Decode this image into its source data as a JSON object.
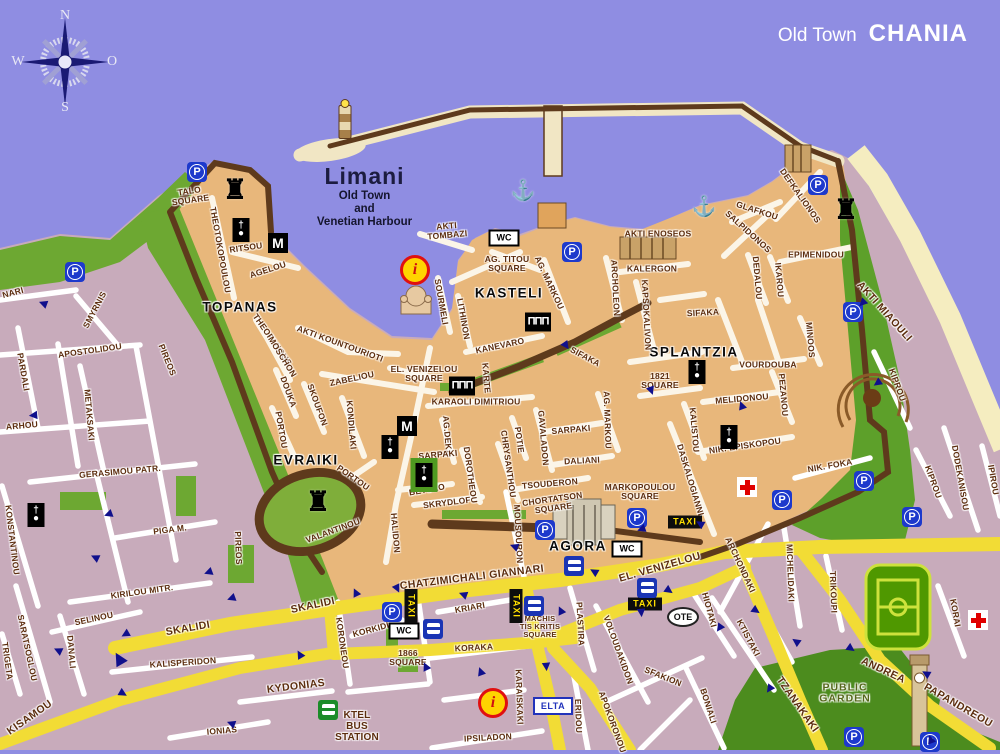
{
  "title": {
    "prefix": "Old Town",
    "name": "CHANIA"
  },
  "compass": {
    "n": "N",
    "e": "O",
    "s": "S",
    "w": "W"
  },
  "harbor": {
    "name": "Limani",
    "line1": "Old Town",
    "line2": "and",
    "line3": "Venetian Harbour"
  },
  "colors": {
    "sea": "#8f8de2",
    "old_town": "#e8b77b",
    "new_town": "#c8abbb",
    "park_green": "#6da832",
    "dark_green": "#4c8c1e",
    "road_yellow": "#f2dc35",
    "wall_brown": "#5e3a1c",
    "sand": "#f5edc0",
    "label_brown": "#5c2d0e",
    "sign_blue": "#1d39cc",
    "arrow_navy": "#10108c",
    "taxi_yellow": "#ffe000"
  },
  "arrow_glyph": "▶",
  "map": {
    "labels": [
      {
        "t": "TALO\nSQUARE",
        "x": 190,
        "y": 196,
        "r": -8,
        "c": "sq"
      },
      {
        "t": "THEOTOKOPOULOU",
        "x": 220,
        "y": 250,
        "r": 80
      },
      {
        "t": "RITSOU",
        "x": 246,
        "y": 248,
        "r": -8
      },
      {
        "t": "AGELOU",
        "x": 268,
        "y": 270,
        "r": -18
      },
      {
        "t": "TOPANAS",
        "x": 240,
        "y": 308,
        "c": "district"
      },
      {
        "t": "KASTELI",
        "x": 509,
        "y": 294,
        "c": "district"
      },
      {
        "t": "EVRAIKI",
        "x": 306,
        "y": 461,
        "c": "district"
      },
      {
        "t": "SPLANTZIA",
        "x": 694,
        "y": 353,
        "c": "district"
      },
      {
        "t": "AGORA",
        "x": 578,
        "y": 547,
        "c": "district"
      },
      {
        "t": "AKTI\nTOMBAZI",
        "x": 447,
        "y": 231,
        "r": -5,
        "c": "sq"
      },
      {
        "t": "AG. TITOU\nSQUARE",
        "x": 507,
        "y": 264,
        "c": "sq"
      },
      {
        "t": "AKTI ENOSEOS",
        "x": 658,
        "y": 234
      },
      {
        "t": "KALERGON",
        "x": 652,
        "y": 269
      },
      {
        "t": "EPIMENIDOU",
        "x": 816,
        "y": 255
      },
      {
        "t": "GLAFKOU",
        "x": 757,
        "y": 211,
        "r": 18
      },
      {
        "t": "SALPIDONOS",
        "x": 748,
        "y": 232,
        "r": 42
      },
      {
        "t": "DEFKALIONOS",
        "x": 800,
        "y": 196,
        "r": 55
      },
      {
        "t": "DEDALOU",
        "x": 757,
        "y": 278,
        "r": 85
      },
      {
        "t": "IKAROU",
        "x": 779,
        "y": 280,
        "r": 85
      },
      {
        "t": "ARCHOLEON",
        "x": 615,
        "y": 288,
        "r": 87
      },
      {
        "t": "KAPSOKALIVON",
        "x": 646,
        "y": 315,
        "r": 87
      },
      {
        "t": "SIFAKA",
        "x": 703,
        "y": 313,
        "r": -3
      },
      {
        "t": "SIFAKA",
        "x": 585,
        "y": 357,
        "r": 28
      },
      {
        "t": "AG. MARKOU",
        "x": 549,
        "y": 283,
        "r": 65
      },
      {
        "t": "AG. MARKOU",
        "x": 607,
        "y": 420,
        "r": 88
      },
      {
        "t": "SOURMELI",
        "x": 441,
        "y": 302,
        "r": 80
      },
      {
        "t": "LITHINON",
        "x": 463,
        "y": 319,
        "r": 80
      },
      {
        "t": "KANEVARO",
        "x": 500,
        "y": 346,
        "r": -12
      },
      {
        "t": "KARTE",
        "x": 486,
        "y": 378,
        "r": 85
      },
      {
        "t": "KARAOLI DIMITRIOU",
        "x": 476,
        "y": 402
      },
      {
        "t": "EL. VENIZELOU\nSQUARE",
        "x": 424,
        "y": 374,
        "c": "sq"
      },
      {
        "t": "AKTI KOUNTOURIOTI",
        "x": 340,
        "y": 344,
        "r": 20
      },
      {
        "t": "THEOFANOUS",
        "x": 272,
        "y": 340,
        "r": 55
      },
      {
        "t": "MOSCHON",
        "x": 282,
        "y": 357,
        "r": 58
      },
      {
        "t": "DOUKA",
        "x": 288,
        "y": 392,
        "r": 70
      },
      {
        "t": "ZABELIOU",
        "x": 352,
        "y": 379,
        "r": -12
      },
      {
        "t": "SKOUFON",
        "x": 317,
        "y": 405,
        "r": 70
      },
      {
        "t": "KONDILAKI",
        "x": 351,
        "y": 425,
        "r": 85
      },
      {
        "t": "PORTOU",
        "x": 281,
        "y": 430,
        "r": 80
      },
      {
        "t": "PORTOU",
        "x": 353,
        "y": 478,
        "r": 35
      },
      {
        "t": "VALANTINOU",
        "x": 333,
        "y": 531,
        "r": -20
      },
      {
        "t": "HALIDON",
        "x": 395,
        "y": 533,
        "r": 85
      },
      {
        "t": "BETOLO",
        "x": 427,
        "y": 490,
        "r": -10
      },
      {
        "t": "SKRYDLOF",
        "x": 447,
        "y": 503,
        "r": -7
      },
      {
        "t": "AG.DEKA",
        "x": 447,
        "y": 436,
        "r": 85
      },
      {
        "t": "SARPAKI",
        "x": 438,
        "y": 455,
        "r": -5
      },
      {
        "t": "DOROTHEOU",
        "x": 470,
        "y": 475,
        "r": 82
      },
      {
        "t": "CHRYSANTHOU",
        "x": 508,
        "y": 464,
        "r": 82
      },
      {
        "t": "POTIE",
        "x": 519,
        "y": 440,
        "r": 82
      },
      {
        "t": "GAVALADON",
        "x": 543,
        "y": 438,
        "r": 85
      },
      {
        "t": "SARPAKI",
        "x": 571,
        "y": 430,
        "r": -5
      },
      {
        "t": "DALIANI",
        "x": 582,
        "y": 461,
        "r": -3
      },
      {
        "t": "TSOUDERON",
        "x": 550,
        "y": 484,
        "r": -5
      },
      {
        "t": "CHORTATSON\nSQUARE",
        "x": 553,
        "y": 504,
        "r": -8,
        "c": "sq"
      },
      {
        "t": "MARKOPOULOU\nSQUARE",
        "x": 640,
        "y": 492,
        "c": "sq"
      },
      {
        "t": "MOUSOURON",
        "x": 518,
        "y": 534,
        "r": 87
      },
      {
        "t": "DASKALOGIANNI",
        "x": 690,
        "y": 480,
        "r": 73
      },
      {
        "t": "KALISTOU",
        "x": 694,
        "y": 430,
        "r": 85
      },
      {
        "t": "NIK. EPISKOPOU",
        "x": 745,
        "y": 446,
        "r": -8
      },
      {
        "t": "MELIDONOU",
        "x": 742,
        "y": 399,
        "r": -5
      },
      {
        "t": "VOURDOUBA",
        "x": 768,
        "y": 365
      },
      {
        "t": "MINOOS",
        "x": 810,
        "y": 340,
        "r": 85
      },
      {
        "t": "PEZANOU",
        "x": 783,
        "y": 395,
        "r": 85
      },
      {
        "t": "1821\nSQUARE",
        "x": 660,
        "y": 381,
        "c": "sq"
      },
      {
        "t": "AKTI MIAOULI",
        "x": 884,
        "y": 312,
        "r": 48,
        "c": "road"
      },
      {
        "t": "KIPROU",
        "x": 897,
        "y": 385,
        "r": 70
      },
      {
        "t": "KIPROU",
        "x": 933,
        "y": 482,
        "r": 70
      },
      {
        "t": "DODEKANISOU",
        "x": 960,
        "y": 478,
        "r": 80
      },
      {
        "t": "IPIROU",
        "x": 993,
        "y": 480,
        "r": 80
      },
      {
        "t": "NIK. FOKA",
        "x": 830,
        "y": 466,
        "r": -10
      },
      {
        "t": "MACHIS\nTIS KRITIS\nSQUARE",
        "x": 540,
        "y": 627,
        "c": "sq",
        "fs": 7.5
      },
      {
        "t": "CHATZIMICHALI GIANNARI",
        "x": 472,
        "y": 578,
        "r": -7,
        "c": "road"
      },
      {
        "t": "EL. VENIZELOU",
        "x": 660,
        "y": 568,
        "r": -16,
        "c": "road"
      },
      {
        "t": "KRIARI",
        "x": 470,
        "y": 608,
        "r": -10
      },
      {
        "t": "KORAKA",
        "x": 474,
        "y": 648,
        "r": -3
      },
      {
        "t": "KORKIDI",
        "x": 371,
        "y": 630,
        "r": -15
      },
      {
        "t": "1866\nSQUARE",
        "x": 408,
        "y": 658,
        "c": "sq"
      },
      {
        "t": "KORONEOU",
        "x": 342,
        "y": 643,
        "r": 82
      },
      {
        "t": "SKALIDI",
        "x": 188,
        "y": 629,
        "r": -10,
        "c": "road"
      },
      {
        "t": "SKALIDI",
        "x": 313,
        "y": 606,
        "r": -12,
        "c": "road"
      },
      {
        "t": "KALISPERIDON",
        "x": 183,
        "y": 663,
        "r": -4
      },
      {
        "t": "KYDONIAS",
        "x": 296,
        "y": 687,
        "r": -7,
        "c": "road"
      },
      {
        "t": "IONIAS",
        "x": 222,
        "y": 731,
        "r": -5
      },
      {
        "t": "KISAMOU",
        "x": 30,
        "y": 718,
        "r": -35,
        "c": "road"
      },
      {
        "t": "SELINOU",
        "x": 94,
        "y": 619,
        "r": -12
      },
      {
        "t": "DANALI",
        "x": 71,
        "y": 652,
        "r": 85
      },
      {
        "t": "SARATSOGLOU",
        "x": 27,
        "y": 648,
        "r": 78
      },
      {
        "t": "TRIGETA",
        "x": 7,
        "y": 661,
        "r": 82
      },
      {
        "t": "KIRILOU MITR.",
        "x": 142,
        "y": 592,
        "r": -8
      },
      {
        "t": "PIGA M.",
        "x": 170,
        "y": 530,
        "r": -7
      },
      {
        "t": "GERASIMOU PATR.",
        "x": 120,
        "y": 472,
        "r": -5
      },
      {
        "t": "KONSTANTINOU",
        "x": 12,
        "y": 540,
        "r": 83
      },
      {
        "t": "METAKSAKI",
        "x": 89,
        "y": 415,
        "r": 85
      },
      {
        "t": "PARDALI",
        "x": 23,
        "y": 372,
        "r": 80
      },
      {
        "t": "APOSTOLIDOU",
        "x": 90,
        "y": 351,
        "r": -8
      },
      {
        "t": "SMYRNIS",
        "x": 95,
        "y": 310,
        "r": -62
      },
      {
        "t": "NARI",
        "x": 13,
        "y": 293,
        "r": -15
      },
      {
        "t": "ARHOU",
        "x": 22,
        "y": 426,
        "r": -5
      },
      {
        "t": "PIREOS",
        "x": 167,
        "y": 360,
        "r": 68
      },
      {
        "t": "PIREOS",
        "x": 238,
        "y": 548,
        "r": 88
      },
      {
        "t": "KTEL\nBUS\nSTATION",
        "x": 357,
        "y": 727,
        "c": "sq",
        "fs": 10
      },
      {
        "t": "IPSILADON",
        "x": 488,
        "y": 738,
        "r": -3
      },
      {
        "t": "KARAISKAKI",
        "x": 519,
        "y": 697,
        "r": 88
      },
      {
        "t": "PLASTIRA",
        "x": 580,
        "y": 624,
        "r": 87
      },
      {
        "t": "VOLOUDAKIDON",
        "x": 618,
        "y": 650,
        "r": 70
      },
      {
        "t": "SFAKION",
        "x": 663,
        "y": 677,
        "r": 22
      },
      {
        "t": "APOKORONOU",
        "x": 612,
        "y": 722,
        "r": 70
      },
      {
        "t": "ERIDOU",
        "x": 578,
        "y": 716,
        "r": 88
      },
      {
        "t": "BONIALI",
        "x": 708,
        "y": 706,
        "r": 72
      },
      {
        "t": "KTISTAKI",
        "x": 748,
        "y": 638,
        "r": 62
      },
      {
        "t": "HIOTAKI",
        "x": 709,
        "y": 610,
        "r": 75
      },
      {
        "t": "TZANAKAKI",
        "x": 797,
        "y": 705,
        "r": 55,
        "c": "road"
      },
      {
        "t": "ARCHONDAKI",
        "x": 740,
        "y": 565,
        "r": 65
      },
      {
        "t": "MICHELIDAKI",
        "x": 790,
        "y": 573,
        "r": 88
      },
      {
        "t": "TRIKOUPI",
        "x": 833,
        "y": 592,
        "r": 88
      },
      {
        "t": "KORAI",
        "x": 955,
        "y": 613,
        "r": 80
      },
      {
        "t": "ANDREA",
        "x": 883,
        "y": 671,
        "r": 25,
        "c": "road"
      },
      {
        "t": "PAPANDREOU",
        "x": 958,
        "y": 706,
        "r": 30,
        "c": "road"
      },
      {
        "t": "PUBLIC\nGARDEN",
        "x": 845,
        "y": 694,
        "c": "garden"
      }
    ],
    "icons": [
      {
        "k": "parking",
        "l": "P",
        "x": 75,
        "y": 272
      },
      {
        "k": "parking",
        "l": "P",
        "x": 197,
        "y": 172
      },
      {
        "k": "parking",
        "l": "P",
        "x": 572,
        "y": 252
      },
      {
        "k": "parking",
        "l": "P",
        "x": 818,
        "y": 185
      },
      {
        "k": "parking",
        "l": "P",
        "x": 853,
        "y": 312
      },
      {
        "k": "parking",
        "l": "P",
        "x": 864,
        "y": 481
      },
      {
        "k": "parking",
        "l": "P",
        "x": 912,
        "y": 517
      },
      {
        "k": "parking",
        "l": "P",
        "x": 782,
        "y": 500
      },
      {
        "k": "parking",
        "l": "P",
        "x": 392,
        "y": 612
      },
      {
        "k": "parking",
        "l": "P",
        "x": 545,
        "y": 530
      },
      {
        "k": "parking",
        "l": "P",
        "x": 637,
        "y": 518
      },
      {
        "k": "parking",
        "l": "P",
        "x": 854,
        "y": 737
      },
      {
        "k": "parking",
        "l": "P",
        "x": 930,
        "y": 742
      },
      {
        "k": "metro",
        "l": "M",
        "x": 278,
        "y": 243
      },
      {
        "k": "metro",
        "l": "M",
        "x": 407,
        "y": 426
      },
      {
        "k": "wc",
        "l": "WC",
        "x": 504,
        "y": 238
      },
      {
        "k": "wc",
        "l": "WC",
        "x": 627,
        "y": 549
      },
      {
        "k": "wc",
        "l": "WC",
        "x": 404,
        "y": 631
      },
      {
        "k": "taxi",
        "l": "TAXI",
        "x": 685,
        "y": 522
      },
      {
        "k": "taxi",
        "l": "TAXI",
        "x": 645,
        "y": 604
      },
      {
        "k": "taxi",
        "l": "TAXI",
        "x": 411,
        "y": 606,
        "r": 90
      },
      {
        "k": "taxi",
        "l": "TAXI",
        "x": 516,
        "y": 606,
        "r": 90
      },
      {
        "k": "elta",
        "l": "ELTA",
        "x": 553,
        "y": 706
      },
      {
        "k": "ote",
        "l": "OTE",
        "x": 683,
        "y": 617
      },
      {
        "k": "info",
        "l": "i",
        "x": 415,
        "y": 270
      },
      {
        "k": "info",
        "l": "i",
        "x": 493,
        "y": 703
      },
      {
        "k": "medical",
        "x": 747,
        "y": 487
      },
      {
        "k": "medical",
        "x": 978,
        "y": 620
      },
      {
        "k": "anchor",
        "l": "⚓",
        "x": 523,
        "y": 191
      },
      {
        "k": "anchor",
        "l": "⚓",
        "x": 704,
        "y": 207
      },
      {
        "k": "bus",
        "x": 433,
        "y": 629
      },
      {
        "k": "bus",
        "x": 534,
        "y": 606
      },
      {
        "k": "bus",
        "x": 574,
        "y": 566
      },
      {
        "k": "bus",
        "x": 647,
        "y": 588
      },
      {
        "k": "busgreen",
        "x": 328,
        "y": 710
      },
      {
        "k": "church",
        "l": "†\n●",
        "x": 241,
        "y": 230
      },
      {
        "k": "church",
        "l": "†\n●",
        "x": 36,
        "y": 515
      },
      {
        "k": "church",
        "l": "†\n●",
        "x": 390,
        "y": 447
      },
      {
        "k": "church",
        "l": "†\n●",
        "x": 697,
        "y": 372
      },
      {
        "k": "church",
        "l": "†\n●",
        "x": 729,
        "y": 437
      },
      {
        "k": "churchgreen",
        "l": "†\n●",
        "x": 424,
        "y": 475
      },
      {
        "k": "castle",
        "l": "♜",
        "x": 235,
        "y": 190
      },
      {
        "k": "castle",
        "l": "♜",
        "x": 846,
        "y": 210
      },
      {
        "k": "castle",
        "l": "♜",
        "x": 318,
        "y": 502
      },
      {
        "k": "temple",
        "l": "ΠΠΠ",
        "x": 538,
        "y": 322
      },
      {
        "k": "temple",
        "l": "ΠΠΠ",
        "x": 462,
        "y": 386
      },
      {
        "k": "lighthouse",
        "x": 345,
        "y": 122
      }
    ],
    "arrows": [
      {
        "x": 43,
        "y": 303,
        "r": 200
      },
      {
        "x": 33,
        "y": 415,
        "r": 175
      },
      {
        "x": 108,
        "y": 514,
        "r": 160
      },
      {
        "x": 95,
        "y": 557,
        "r": 205
      },
      {
        "x": 125,
        "y": 634,
        "r": 150
      },
      {
        "x": 58,
        "y": 650,
        "r": 205
      },
      {
        "x": 118,
        "y": 659,
        "r": 240,
        "s": 2
      },
      {
        "x": 123,
        "y": 694,
        "r": 30
      },
      {
        "x": 231,
        "y": 723,
        "r": 200
      },
      {
        "x": 356,
        "y": 592,
        "r": 245
      },
      {
        "x": 397,
        "y": 589,
        "r": 65
      },
      {
        "x": 426,
        "y": 666,
        "r": 245
      },
      {
        "x": 561,
        "y": 610,
        "r": 245
      },
      {
        "x": 641,
        "y": 613,
        "r": 85
      },
      {
        "x": 756,
        "y": 611,
        "r": 35
      },
      {
        "x": 796,
        "y": 641,
        "r": 215
      },
      {
        "x": 851,
        "y": 649,
        "r": 35
      },
      {
        "x": 926,
        "y": 673,
        "r": 210
      },
      {
        "x": 862,
        "y": 303,
        "r": 135
      },
      {
        "x": 877,
        "y": 383,
        "r": 145
      },
      {
        "x": 742,
        "y": 405,
        "r": 250
      },
      {
        "x": 651,
        "y": 391,
        "r": 70
      },
      {
        "x": 566,
        "y": 346,
        "r": 55
      },
      {
        "x": 641,
        "y": 529,
        "r": 160
      },
      {
        "x": 514,
        "y": 546,
        "r": 200
      },
      {
        "x": 231,
        "y": 598,
        "r": 160
      },
      {
        "x": 481,
        "y": 671,
        "r": 250
      },
      {
        "x": 546,
        "y": 667,
        "r": 85
      },
      {
        "x": 669,
        "y": 591,
        "r": 35
      },
      {
        "x": 719,
        "y": 628,
        "r": 125
      },
      {
        "x": 769,
        "y": 689,
        "r": 125
      },
      {
        "x": 931,
        "y": 739,
        "r": 250
      },
      {
        "x": 208,
        "y": 572,
        "r": 160
      },
      {
        "x": 300,
        "y": 654,
        "r": 240
      },
      {
        "x": 594,
        "y": 571,
        "r": 210
      },
      {
        "x": 700,
        "y": 523,
        "r": 210
      },
      {
        "x": 463,
        "y": 594,
        "r": 200
      }
    ]
  }
}
